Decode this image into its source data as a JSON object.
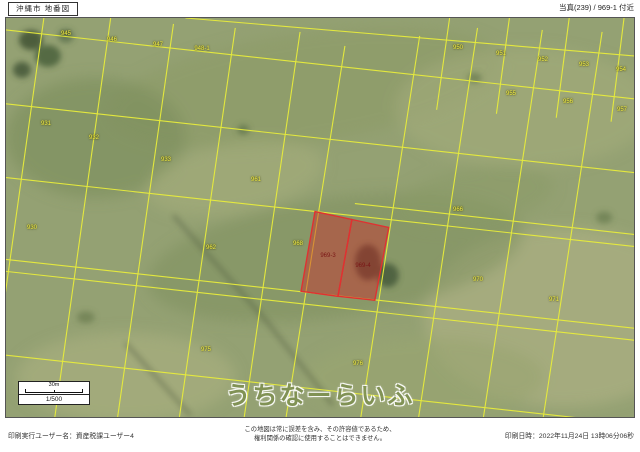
{
  "header": {
    "title": "沖縄市 地番図",
    "location": "当真(239) / 969-1 付近"
  },
  "map": {
    "watermark": "うちなーらいふ",
    "scale_bar_label": "30m",
    "scale_ratio": "1/500",
    "colors": {
      "boundary_line": "#e8ec3c",
      "highlight_fill": "#cc2b2b",
      "highlight_border": "#e03131"
    },
    "parcel_labels": [
      {
        "text": "945",
        "x": 60,
        "y": 16
      },
      {
        "text": "946",
        "x": 106,
        "y": 22
      },
      {
        "text": "947",
        "x": 152,
        "y": 27
      },
      {
        "text": "948-1",
        "x": 196,
        "y": 31
      },
      {
        "text": "950",
        "x": 452,
        "y": 30
      },
      {
        "text": "951",
        "x": 495,
        "y": 36
      },
      {
        "text": "952",
        "x": 537,
        "y": 42
      },
      {
        "text": "953",
        "x": 578,
        "y": 47
      },
      {
        "text": "954",
        "x": 615,
        "y": 52
      },
      {
        "text": "955",
        "x": 505,
        "y": 76
      },
      {
        "text": "956",
        "x": 562,
        "y": 84
      },
      {
        "text": "957",
        "x": 616,
        "y": 92
      },
      {
        "text": "931",
        "x": 40,
        "y": 106
      },
      {
        "text": "932",
        "x": 88,
        "y": 120
      },
      {
        "text": "933",
        "x": 160,
        "y": 142
      },
      {
        "text": "930",
        "x": 26,
        "y": 210
      },
      {
        "text": "961",
        "x": 250,
        "y": 162
      },
      {
        "text": "962",
        "x": 205,
        "y": 230
      },
      {
        "text": "968",
        "x": 292,
        "y": 226
      },
      {
        "text": "966",
        "x": 452,
        "y": 192
      },
      {
        "text": "970",
        "x": 472,
        "y": 262
      },
      {
        "text": "971",
        "x": 548,
        "y": 282
      },
      {
        "text": "975",
        "x": 200,
        "y": 332
      },
      {
        "text": "976",
        "x": 352,
        "y": 346
      },
      {
        "text": "969-3",
        "x": 322,
        "y": 238,
        "highlight": true
      },
      {
        "text": "969-4",
        "x": 357,
        "y": 248,
        "highlight": true
      }
    ]
  },
  "footer": {
    "printed_by": "印刷実行ユーザー名：資産税課ユーザー4",
    "disclaimer_line1": "この地図は常に誤差を含み、その許容値であるため、",
    "disclaimer_line2": "権利関係の確認に使用することはできません。",
    "printed_at": "印刷日時：2022年11月24日 13時06分06秒"
  }
}
